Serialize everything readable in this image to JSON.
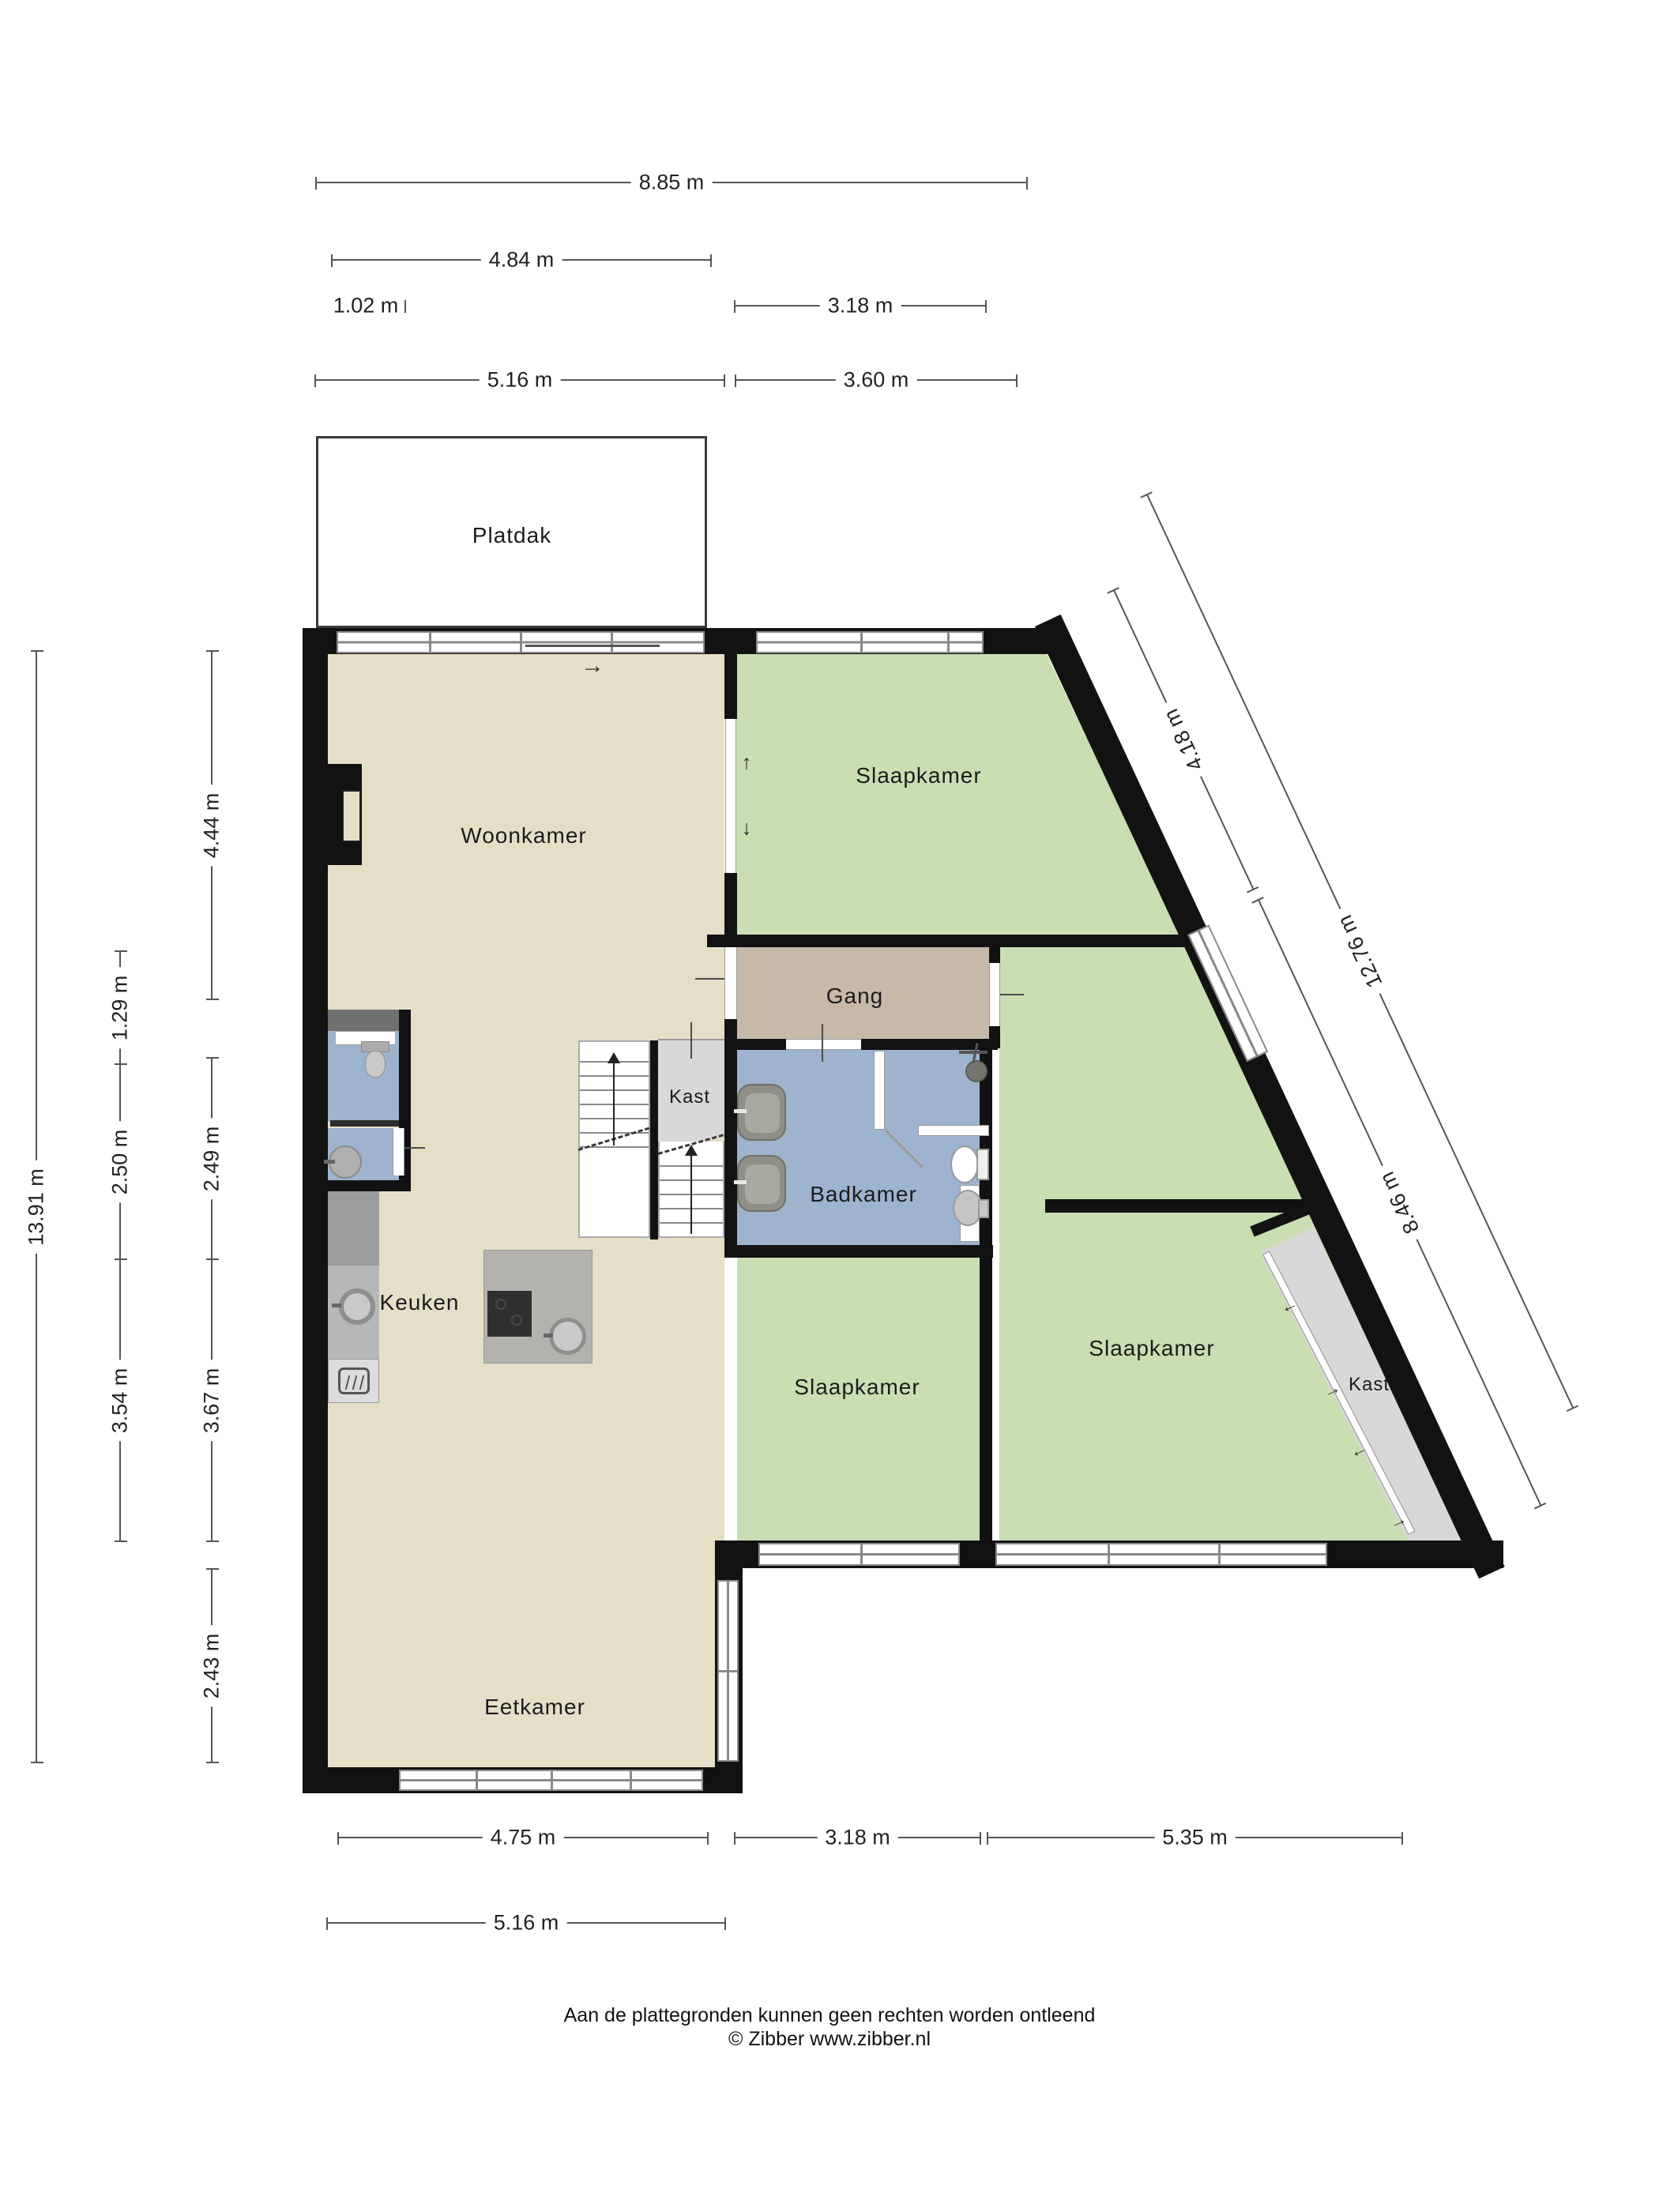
{
  "title": "Plattegrond",
  "palette": {
    "wall": "#121212",
    "floor_living": "#E6DFC8",
    "floor_bedroom": "#C9DFB3",
    "floor_hall": "#C7B9A7",
    "floor_bath": "#9DB3CE",
    "floor_closet": "#D8D8D8",
    "window_frame": "#8A8A8A",
    "dim_line": "#555555"
  },
  "rooms": {
    "platdak": {
      "label": "Platdak"
    },
    "woonkamer": {
      "label": "Woonkamer"
    },
    "slaapkamer_top": {
      "label": "Slaapkamer"
    },
    "gang": {
      "label": "Gang"
    },
    "kast_mid": {
      "label": "Kast"
    },
    "badkamer": {
      "label": "Badkamer"
    },
    "keuken": {
      "label": "Keuken"
    },
    "slaapkamer_mid": {
      "label": "Slaapkamer"
    },
    "slaapkamer_right": {
      "label": "Slaapkamer"
    },
    "kast_right": {
      "label": "Kast"
    },
    "eetkamer": {
      "label": "Eetkamer"
    }
  },
  "dims": {
    "top": [
      {
        "label": "8.85 m"
      },
      {
        "label": "4.84 m"
      },
      {
        "label": "1.02 m"
      },
      {
        "label": "3.18 m"
      },
      {
        "label": "5.16 m"
      },
      {
        "label": "3.60 m"
      }
    ],
    "left": [
      {
        "label": "13.91 m"
      },
      {
        "label": "1.29 m"
      },
      {
        "label": "2.50 m"
      },
      {
        "label": "3.54 m"
      },
      {
        "label": "4.44 m"
      },
      {
        "label": "2.49 m"
      },
      {
        "label": "3.67 m"
      },
      {
        "label": "2.43 m"
      }
    ],
    "bottom": [
      {
        "label": "4.75 m"
      },
      {
        "label": "3.18 m"
      },
      {
        "label": "5.35 m"
      },
      {
        "label": "5.16 m"
      }
    ],
    "diagonal": [
      {
        "label": "4.18 m"
      },
      {
        "label": "12.76 m"
      },
      {
        "label": "8.46 m"
      }
    ]
  },
  "icons": {
    "entry_arrow": "→",
    "slide_up": "↑",
    "slide_down": "↓"
  },
  "footer": {
    "line1": "Aan de plattegronden kunnen geen rechten worden ontleend",
    "line2": "© Zibber www.zibber.nl"
  }
}
